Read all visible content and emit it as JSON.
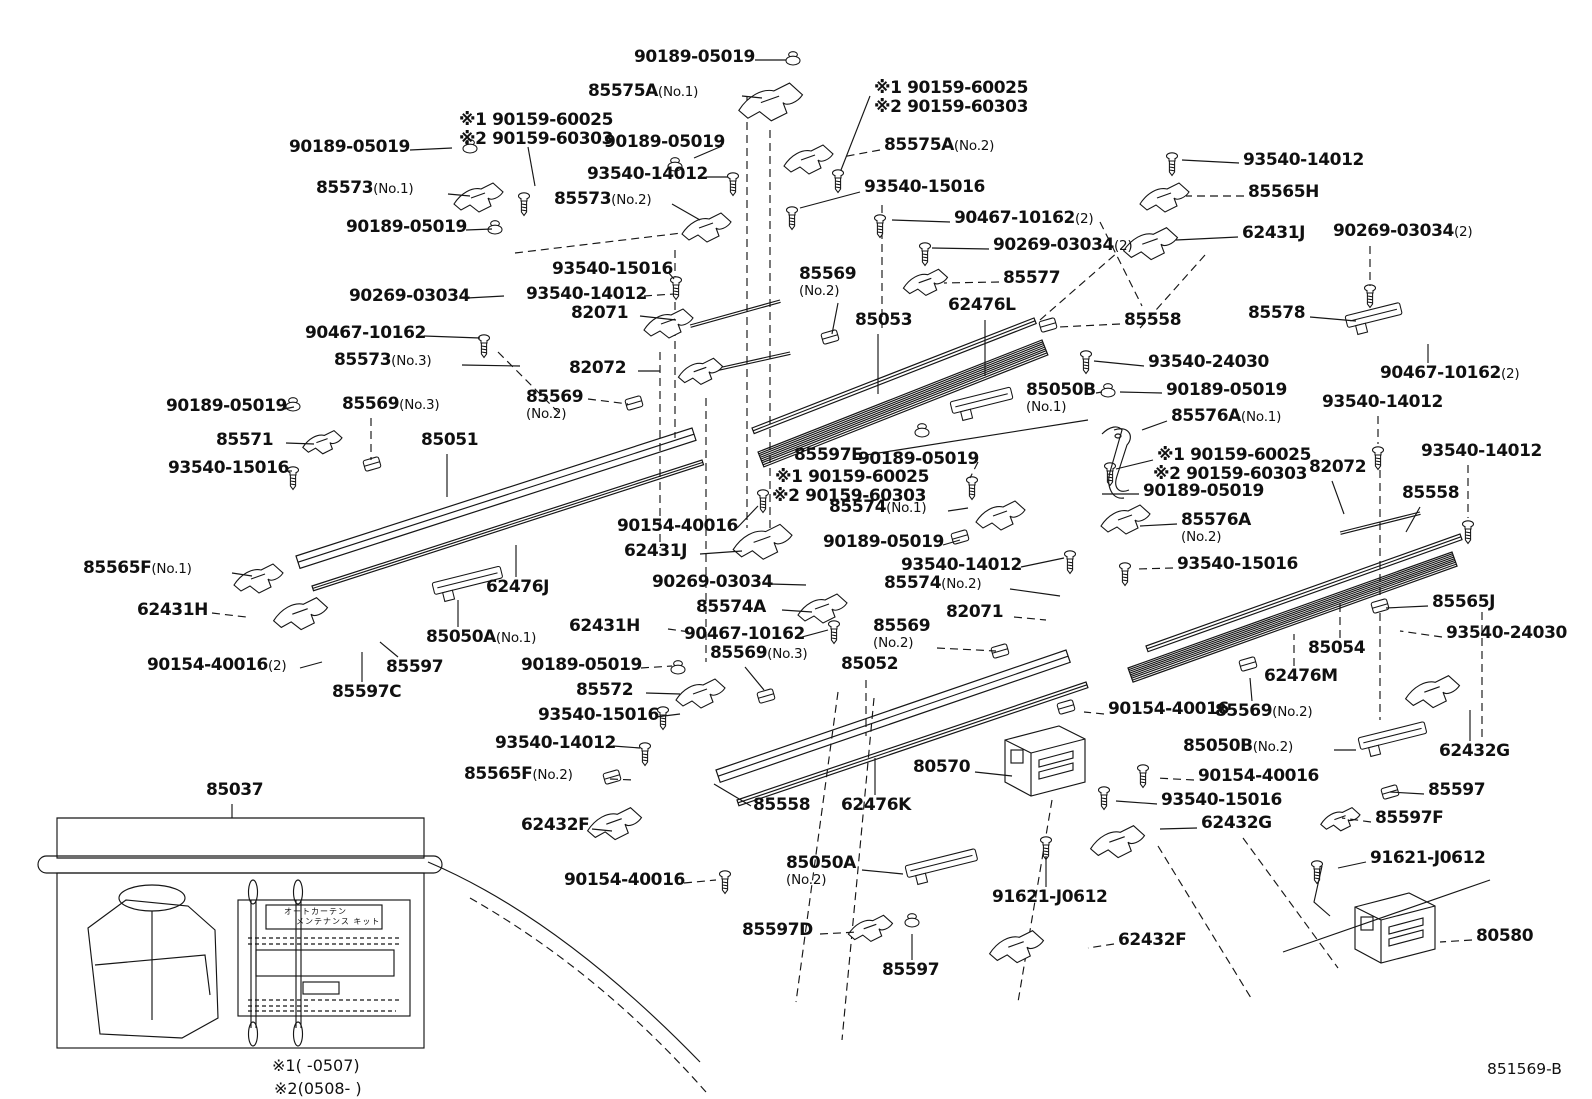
{
  "figure": {
    "footer_code": "851569-B",
    "note1": "※1(      -0507)",
    "note2": "※2(0508-      )",
    "kit": {
      "label_ref": "85037",
      "sheet_line1": "オートカーテン",
      "sheet_line2": "メンテナンス キット"
    }
  },
  "labels": [
    {
      "n": "90189-05019",
      "x": 634,
      "y": 49,
      "l": [
        755,
        60,
        786,
        60
      ]
    },
    {
      "n": "85575A",
      "s": "(No.1)",
      "x": 588,
      "y": 83,
      "l": [
        742,
        96,
        762,
        98
      ]
    },
    {
      "n": "※1 90159-60025",
      "x": 874,
      "y": 80,
      "l": [
        870,
        96,
        841,
        170
      ]
    },
    {
      "n": "※2 90159-60303",
      "x": 874,
      "y": 99
    },
    {
      "n": "※1 90159-60025",
      "x": 459,
      "y": 112
    },
    {
      "n": "※2 90159-60303",
      "x": 459,
      "y": 131,
      "l": [
        528,
        147,
        535,
        186
      ]
    },
    {
      "n": "90189-05019",
      "x": 289,
      "y": 139,
      "l": [
        410,
        150,
        452,
        148
      ]
    },
    {
      "n": "90189-05019",
      "x": 604,
      "y": 134,
      "l": [
        722,
        146,
        694,
        158
      ]
    },
    {
      "n": "85575A",
      "s": "(No.2)",
      "x": 884,
      "y": 137,
      "l": [
        880,
        150,
        842,
        157
      ],
      "ld": 1
    },
    {
      "n": "85573",
      "s": "(No.1)",
      "x": 316,
      "y": 180,
      "l": [
        448,
        194,
        470,
        196
      ]
    },
    {
      "n": "93540-14012",
      "x": 587,
      "y": 166,
      "l": [
        706,
        177,
        728,
        177
      ]
    },
    {
      "n": "85573",
      "s": "(No.2)",
      "x": 554,
      "y": 191,
      "l": [
        672,
        204,
        700,
        220
      ]
    },
    {
      "n": "93540-15016",
      "x": 864,
      "y": 179,
      "l": [
        860,
        192,
        800,
        208
      ]
    },
    {
      "n": "90189-05019",
      "x": 346,
      "y": 219,
      "l": [
        466,
        230,
        492,
        229
      ]
    },
    {
      "n": "93540-14012",
      "x": 1243,
      "y": 152,
      "l": [
        1239,
        163,
        1182,
        160
      ]
    },
    {
      "n": "85565H",
      "x": 1248,
      "y": 184,
      "l": [
        1244,
        196,
        1186,
        196
      ],
      "ld": 1
    },
    {
      "n": "62431J",
      "x": 1242,
      "y": 225,
      "l": [
        1238,
        237,
        1176,
        240
      ]
    },
    {
      "n": "90269-03034",
      "s": "(2)",
      "x": 1333,
      "y": 223,
      "l": [
        1370,
        246,
        1370,
        286
      ],
      "ld": 1
    },
    {
      "n": "90467-10162",
      "s": "(2)",
      "x": 954,
      "y": 210,
      "l": [
        950,
        222,
        892,
        220
      ]
    },
    {
      "n": "90269-03034",
      "s": "(2)",
      "x": 993,
      "y": 237,
      "l": [
        989,
        249,
        932,
        248
      ]
    },
    {
      "n": "93540-15016",
      "x": 552,
      "y": 261,
      "l": [
        668,
        272,
        674,
        279
      ]
    },
    {
      "n": "85569",
      "s": "(No.2)",
      "st": 1,
      "x": 799,
      "y": 266,
      "l": [
        838,
        303,
        832,
        334
      ]
    },
    {
      "n": "85577",
      "x": 1003,
      "y": 270,
      "l": [
        999,
        282,
        944,
        283
      ],
      "ld": 1
    },
    {
      "n": "93540-14012",
      "x": 526,
      "y": 286,
      "l": [
        644,
        296,
        674,
        294
      ],
      "ld": 1
    },
    {
      "n": "90269-03034",
      "x": 349,
      "y": 288,
      "l": [
        467,
        298,
        504,
        296
      ]
    },
    {
      "n": "82071",
      "x": 571,
      "y": 305,
      "l": [
        640,
        316,
        676,
        320
      ]
    },
    {
      "n": "85053",
      "x": 855,
      "y": 312,
      "l": [
        878,
        334,
        878,
        394
      ]
    },
    {
      "n": "62476L",
      "x": 948,
      "y": 297,
      "l": [
        985,
        320,
        985,
        376
      ]
    },
    {
      "n": "85558",
      "x": 1124,
      "y": 312,
      "l": [
        1120,
        324,
        1058,
        327
      ],
      "ld": 1
    },
    {
      "n": "85578",
      "x": 1248,
      "y": 305,
      "l": [
        1310,
        317,
        1356,
        321
      ]
    },
    {
      "n": "90467-10162",
      "x": 305,
      "y": 325,
      "l": [
        424,
        336,
        480,
        338
      ]
    },
    {
      "n": "85573",
      "s": "(No.3)",
      "x": 334,
      "y": 352,
      "l": [
        462,
        365,
        520,
        366
      ]
    },
    {
      "n": "82072",
      "x": 569,
      "y": 360,
      "l": [
        638,
        371,
        660,
        371
      ]
    },
    {
      "n": "93540-24030",
      "x": 1148,
      "y": 354,
      "l": [
        1144,
        366,
        1094,
        361
      ]
    },
    {
      "n": "90467-10162",
      "s": "(2)",
      "x": 1380,
      "y": 365,
      "l": [
        1428,
        363,
        1428,
        344
      ]
    },
    {
      "n": "90189-05019",
      "x": 166,
      "y": 398,
      "l": [
        284,
        409,
        294,
        407
      ]
    },
    {
      "n": "85569",
      "s": "(No.3)",
      "x": 342,
      "y": 396,
      "l": [
        371,
        418,
        371,
        460
      ],
      "ld": 1
    },
    {
      "n": "85569",
      "s": "(No.2)",
      "st": 1,
      "x": 526,
      "y": 389,
      "l": [
        588,
        399,
        628,
        404
      ],
      "ld": 1
    },
    {
      "n": "85051",
      "x": 421,
      "y": 432,
      "l": [
        447,
        454,
        447,
        497
      ]
    },
    {
      "n": "85050B",
      "s": "(No.1)",
      "st": 1,
      "x": 1026,
      "y": 382,
      "l": [
        1096,
        393,
        1102,
        392
      ]
    },
    {
      "n": "90189-05019",
      "x": 1166,
      "y": 382,
      "l": [
        1162,
        393,
        1120,
        392
      ]
    },
    {
      "n": "85571",
      "x": 216,
      "y": 432,
      "l": [
        286,
        443,
        314,
        444
      ]
    },
    {
      "n": "85576A",
      "s": "(No.1)",
      "x": 1171,
      "y": 408,
      "l": [
        1167,
        421,
        1142,
        430
      ]
    },
    {
      "n": "93540-15016",
      "x": 168,
      "y": 460,
      "l": [
        286,
        471,
        292,
        471
      ]
    },
    {
      "n": "※1 90159-60025",
      "x": 1157,
      "y": 447,
      "l": [
        1153,
        460,
        1116,
        469
      ]
    },
    {
      "n": "※2 90159-60303",
      "x": 1153,
      "y": 466
    },
    {
      "n": "93540-14012",
      "x": 1322,
      "y": 394,
      "l": [
        1378,
        416,
        1378,
        444
      ],
      "ld": 1
    },
    {
      "n": "82072",
      "x": 1309,
      "y": 459,
      "l": [
        1332,
        481,
        1344,
        514
      ]
    },
    {
      "n": "93540-14012",
      "x": 1421,
      "y": 443,
      "l": [
        1468,
        465,
        1468,
        518
      ],
      "ld": 1
    },
    {
      "n": "85558",
      "x": 1402,
      "y": 485,
      "l": [
        1420,
        507,
        1406,
        532
      ]
    },
    {
      "n": "85597E",
      "x": 794,
      "y": 447,
      "l": [
        866,
        455,
        1088,
        420
      ]
    },
    {
      "n": "※1 90159-60025",
      "x": 775,
      "y": 469
    },
    {
      "n": "※2 90159-60303",
      "x": 772,
      "y": 488
    },
    {
      "n": "85574",
      "s": "(No.1)",
      "x": 829,
      "y": 499,
      "l": [
        948,
        511,
        968,
        508
      ]
    },
    {
      "n": "90189-05019",
      "x": 858,
      "y": 451,
      "l": [
        978,
        462,
        970,
        478
      ],
      "ld": 1
    },
    {
      "n": "90154-40016",
      "x": 617,
      "y": 518,
      "l": [
        737,
        528,
        758,
        506
      ]
    },
    {
      "n": "62431J",
      "x": 624,
      "y": 543,
      "l": [
        700,
        554,
        742,
        551
      ]
    },
    {
      "n": "90189-05019",
      "x": 823,
      "y": 534,
      "l": [
        943,
        545,
        960,
        540
      ]
    },
    {
      "n": "85576A",
      "s": "(No.2)",
      "st": 1,
      "x": 1181,
      "y": 512,
      "l": [
        1177,
        524,
        1140,
        526
      ]
    },
    {
      "n": "90189-05019",
      "x": 1143,
      "y": 483,
      "l": [
        1139,
        494,
        1102,
        494
      ]
    },
    {
      "n": "93540-14012",
      "x": 901,
      "y": 557,
      "l": [
        1021,
        567,
        1064,
        558
      ]
    },
    {
      "n": "93540-15016",
      "x": 1177,
      "y": 556,
      "l": [
        1173,
        568,
        1138,
        569
      ],
      "ld": 1
    },
    {
      "n": "85565F",
      "s": "(No.1)",
      "x": 83,
      "y": 560,
      "l": [
        232,
        573,
        252,
        576
      ]
    },
    {
      "n": "62431H",
      "x": 137,
      "y": 602,
      "l": [
        212,
        613,
        246,
        617
      ],
      "ld": 1
    },
    {
      "n": "62476J",
      "x": 486,
      "y": 579,
      "l": [
        516,
        577,
        516,
        545
      ]
    },
    {
      "n": "85574",
      "s": "(No.2)",
      "x": 884,
      "y": 575,
      "l": [
        1010,
        589,
        1060,
        596
      ]
    },
    {
      "n": "90269-03034",
      "x": 652,
      "y": 574,
      "l": [
        770,
        584,
        806,
        585
      ]
    },
    {
      "n": "85574A",
      "x": 696,
      "y": 599,
      "l": [
        782,
        610,
        812,
        612
      ]
    },
    {
      "n": "62431H",
      "x": 569,
      "y": 618,
      "l": [
        668,
        629,
        690,
        632
      ],
      "ld": 1
    },
    {
      "n": "90467-10162",
      "x": 684,
      "y": 626,
      "l": [
        802,
        637,
        828,
        630
      ]
    },
    {
      "n": "85569",
      "s": "(No.3)",
      "x": 710,
      "y": 645,
      "l": [
        745,
        667,
        764,
        690
      ]
    },
    {
      "n": "85569",
      "s": "(No.2)",
      "st": 1,
      "x": 873,
      "y": 618,
      "l": [
        937,
        648,
        996,
        651
      ],
      "ld": 1
    },
    {
      "n": "82071",
      "x": 946,
      "y": 604,
      "l": [
        1014,
        617,
        1046,
        620
      ],
      "ld": 1
    },
    {
      "n": "85052",
      "x": 841,
      "y": 656,
      "l": [
        866,
        680,
        866,
        736
      ],
      "ld": 1
    },
    {
      "n": "90154-40016",
      "s": "(2)",
      "x": 147,
      "y": 657,
      "l": [
        300,
        668,
        322,
        662
      ]
    },
    {
      "n": "85597",
      "x": 386,
      "y": 659,
      "l": [
        398,
        657,
        380,
        642
      ]
    },
    {
      "n": "85597C",
      "x": 332,
      "y": 684,
      "l": [
        362,
        682,
        362,
        652
      ]
    },
    {
      "n": "85050A",
      "s": "(No.1)",
      "x": 426,
      "y": 629,
      "l": [
        458,
        627,
        458,
        600
      ]
    },
    {
      "n": "90189-05019",
      "x": 521,
      "y": 657,
      "l": [
        641,
        668,
        672,
        666
      ],
      "ld": 1
    },
    {
      "n": "85572",
      "x": 576,
      "y": 682,
      "l": [
        646,
        693,
        680,
        694
      ]
    },
    {
      "n": "93540-15016",
      "x": 538,
      "y": 707,
      "l": [
        656,
        717,
        680,
        714
      ]
    },
    {
      "n": "93540-14012",
      "x": 495,
      "y": 735,
      "l": [
        613,
        746,
        640,
        748
      ]
    },
    {
      "n": "85565F",
      "s": "(No.2)",
      "x": 464,
      "y": 766,
      "l": [
        610,
        779,
        634,
        780
      ],
      "ld": 1
    },
    {
      "n": "62432F",
      "x": 521,
      "y": 817,
      "l": [
        592,
        829,
        612,
        831
      ]
    },
    {
      "n": "85558",
      "x": 753,
      "y": 797,
      "l": [
        751,
        806,
        714,
        784
      ]
    },
    {
      "n": "62476K",
      "x": 841,
      "y": 797,
      "l": [
        875,
        795,
        875,
        758
      ]
    },
    {
      "n": "90154-40016",
      "x": 564,
      "y": 872,
      "l": [
        684,
        883,
        716,
        880
      ],
      "ld": 1
    },
    {
      "n": "85050A",
      "s": "(No.2)",
      "st": 1,
      "x": 786,
      "y": 855,
      "l": [
        862,
        870,
        903,
        874
      ]
    },
    {
      "n": "85597D",
      "x": 742,
      "y": 922,
      "l": [
        820,
        934,
        858,
        932
      ],
      "ld": 1
    },
    {
      "n": "85597",
      "x": 882,
      "y": 962,
      "l": [
        912,
        960,
        912,
        934
      ]
    },
    {
      "n": "91621-J0612",
      "x": 992,
      "y": 889,
      "l": [
        1046,
        887,
        1046,
        856
      ]
    },
    {
      "n": "62432F",
      "x": 1118,
      "y": 932,
      "l": [
        1114,
        944,
        1088,
        948
      ],
      "ld": 1
    },
    {
      "n": "80570",
      "x": 913,
      "y": 759,
      "l": [
        975,
        772,
        1012,
        776
      ]
    },
    {
      "n": "90154-40016",
      "x": 1198,
      "y": 768,
      "l": [
        1194,
        780,
        1156,
        778
      ],
      "ld": 1
    },
    {
      "n": "93540-15016",
      "x": 1161,
      "y": 792,
      "l": [
        1157,
        804,
        1116,
        801
      ]
    },
    {
      "n": "62432G",
      "x": 1201,
      "y": 815,
      "l": [
        1197,
        828,
        1160,
        829
      ]
    },
    {
      "n": "85050B",
      "s": "(No.2)",
      "x": 1183,
      "y": 738,
      "l": [
        1334,
        750,
        1356,
        750
      ]
    },
    {
      "n": "85054",
      "x": 1308,
      "y": 640,
      "l": [
        1340,
        638,
        1340,
        604
      ],
      "ld": 1
    },
    {
      "n": "62476M",
      "x": 1264,
      "y": 668,
      "l": [
        1294,
        666,
        1294,
        634
      ],
      "ld": 1
    },
    {
      "n": "85569",
      "s": "(No.2)",
      "x": 1215,
      "y": 703,
      "l": [
        1252,
        701,
        1250,
        678
      ]
    },
    {
      "n": "90154-40016",
      "x": 1108,
      "y": 701,
      "l": [
        1104,
        714,
        1084,
        712
      ],
      "ld": 1
    },
    {
      "n": "80580",
      "x": 1476,
      "y": 928,
      "l": [
        1472,
        940,
        1440,
        942
      ],
      "ld": 1
    },
    {
      "n": "91621-J0612",
      "x": 1370,
      "y": 850,
      "l": [
        1366,
        862,
        1338,
        868
      ]
    },
    {
      "n": "62432G",
      "x": 1439,
      "y": 743,
      "l": [
        1470,
        741,
        1470,
        710
      ]
    },
    {
      "n": "85597",
      "x": 1428,
      "y": 782,
      "l": [
        1424,
        794,
        1390,
        792
      ]
    },
    {
      "n": "85597F",
      "x": 1375,
      "y": 810,
      "l": [
        1371,
        822,
        1342,
        818
      ],
      "ld": 1
    },
    {
      "n": "93540-24030",
      "x": 1446,
      "y": 625,
      "l": [
        1442,
        637,
        1400,
        631
      ],
      "ld": 1
    },
    {
      "n": "85565J",
      "x": 1432,
      "y": 594,
      "l": [
        1428,
        606,
        1386,
        608
      ]
    },
    {
      "n": "85037",
      "x": 206,
      "y": 782,
      "l": [
        232,
        804,
        232,
        818
      ]
    }
  ]
}
